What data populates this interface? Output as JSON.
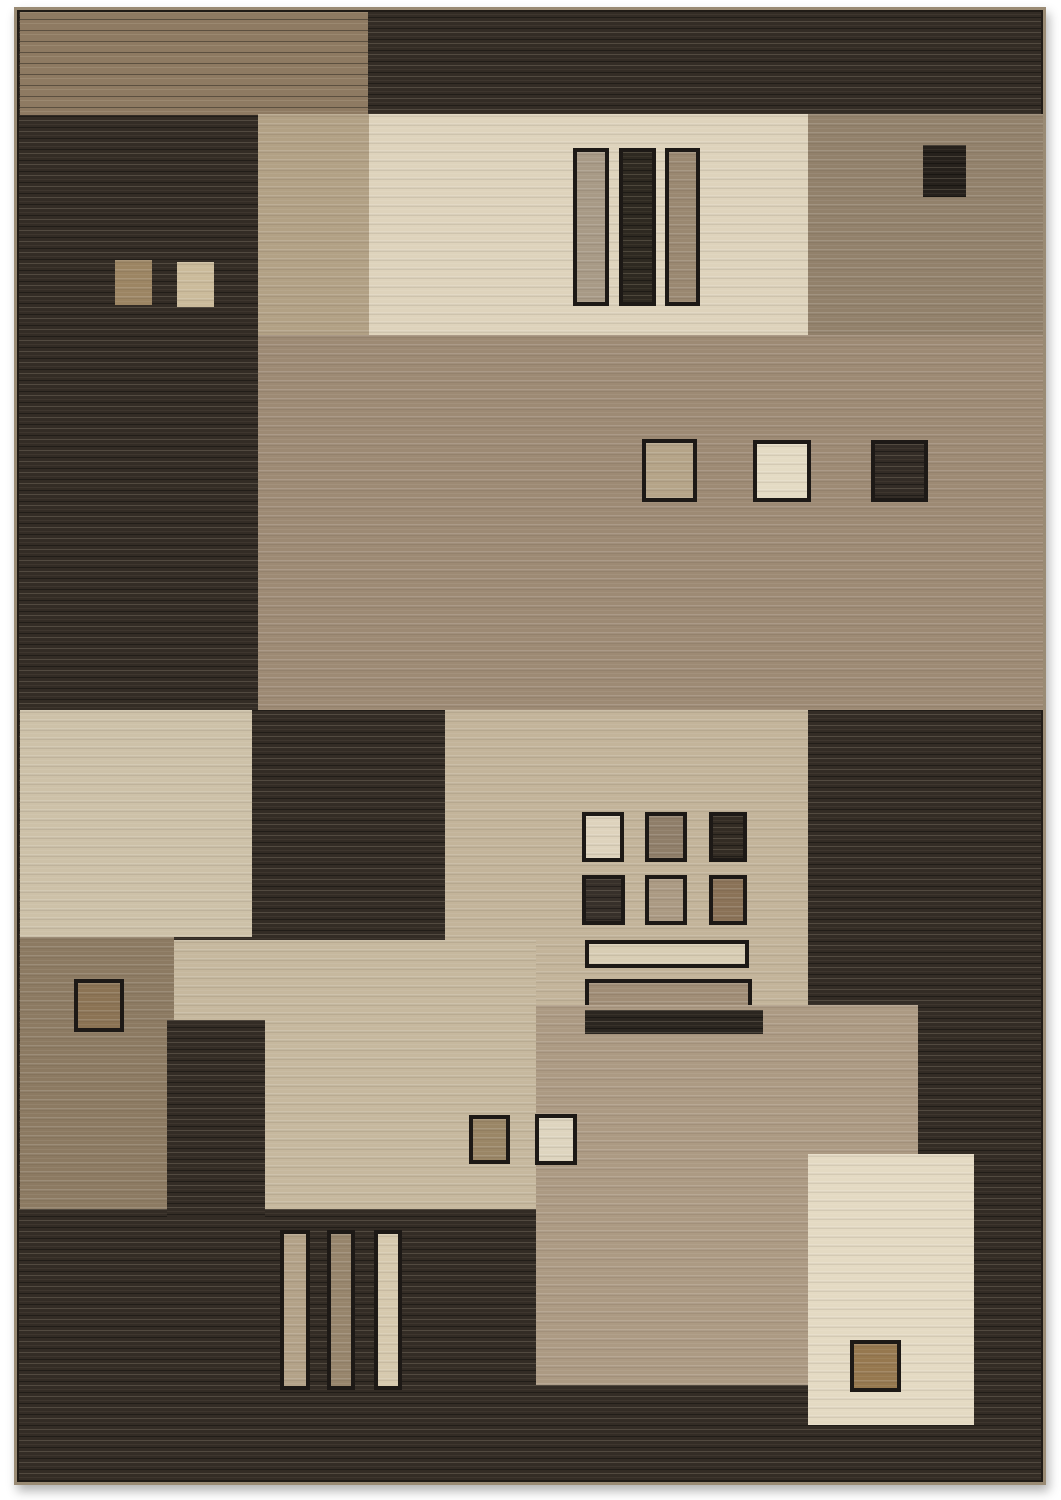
{
  "image": {
    "description": "Product photograph of a modern geometric area rug with striated pile, composed of overlapping rectangles and small squares in dark espresso, brown, taupe, beige and cream tones on a white background.",
    "page_background": "#ffffff",
    "palette": {
      "dark_espresso": "#332c25",
      "brown": "#8e7a62",
      "taupe": "#92816b",
      "tan": "#9d8a74",
      "light_tan": "#b2a185",
      "beige": "#c3b49a",
      "cream": "#ded3bc",
      "outline": "#1d1916",
      "binding_edge": "#9a8b74"
    }
  },
  "rug": {
    "x": 14,
    "y": 7,
    "width": 1032,
    "height": 1478,
    "base_color": "#332c25",
    "panels": [
      {
        "name": "top-brown-band",
        "x": 3,
        "y": 2,
        "w": 348,
        "h": 103,
        "color": "#8e7a62",
        "texture": "dark",
        "border": false
      },
      {
        "name": "upper-tan-column",
        "x": 241,
        "y": 104,
        "w": 111,
        "h": 221,
        "color": "#b2a185",
        "texture": "light",
        "border": false
      },
      {
        "name": "top-cream-panel",
        "x": 352,
        "y": 104,
        "w": 439,
        "h": 221,
        "color": "#ded3bc",
        "texture": "light",
        "border": false
      },
      {
        "name": "cream-panel-bar-left",
        "x": 556,
        "y": 138,
        "w": 36,
        "h": 158,
        "color": "#a89a86",
        "texture": "light",
        "border": true
      },
      {
        "name": "cream-panel-bar-middle",
        "x": 602,
        "y": 138,
        "w": 37,
        "h": 158,
        "color": "#2e2921",
        "texture": "dark",
        "border": true
      },
      {
        "name": "cream-panel-bar-right",
        "x": 648,
        "y": 138,
        "w": 35,
        "h": 158,
        "color": "#9a8871",
        "texture": "light",
        "border": true
      },
      {
        "name": "top-right-taupe-panel",
        "x": 791,
        "y": 104,
        "w": 235,
        "h": 221,
        "color": "#92816b",
        "texture": "light",
        "border": false
      },
      {
        "name": "taupe-panel-dark-square",
        "x": 906,
        "y": 135,
        "w": 43,
        "h": 52,
        "color": "#26211c",
        "texture": "dark",
        "border": false
      },
      {
        "name": "middle-tan-band",
        "x": 241,
        "y": 325,
        "w": 785,
        "h": 375,
        "color": "#9d8a74",
        "texture": "light",
        "border": false
      },
      {
        "name": "tan-band-square-tan",
        "x": 625,
        "y": 429,
        "w": 55,
        "h": 63,
        "color": "#b5a488",
        "texture": "light",
        "border": true
      },
      {
        "name": "tan-band-square-cream",
        "x": 736,
        "y": 430,
        "w": 58,
        "h": 62,
        "color": "#e4dbc4",
        "texture": "light",
        "border": true
      },
      {
        "name": "tan-band-square-dark",
        "x": 854,
        "y": 430,
        "w": 57,
        "h": 62,
        "color": "#332c26",
        "texture": "dark",
        "border": true
      },
      {
        "name": "dark-field-square-brown",
        "x": 98,
        "y": 250,
        "w": 37,
        "h": 45,
        "color": "#9c8563",
        "texture": "light",
        "border": false
      },
      {
        "name": "dark-field-square-cream",
        "x": 160,
        "y": 252,
        "w": 37,
        "h": 45,
        "color": "#cbbb9b",
        "texture": "light",
        "border": false
      },
      {
        "name": "left-cream-panel",
        "x": 3,
        "y": 700,
        "w": 232,
        "h": 227,
        "color": "#cdc1a8",
        "texture": "light",
        "border": false
      },
      {
        "name": "center-beige-square",
        "x": 428,
        "y": 700,
        "w": 363,
        "h": 295,
        "color": "#c3b49a",
        "texture": "light",
        "border": false
      },
      {
        "name": "grid-square-r1-cream",
        "x": 565,
        "y": 802,
        "w": 42,
        "h": 50,
        "color": "#ded3bd",
        "texture": "light",
        "border": true
      },
      {
        "name": "grid-square-r1-taupe",
        "x": 628,
        "y": 802,
        "w": 42,
        "h": 50,
        "color": "#8f7e69",
        "texture": "light",
        "border": true
      },
      {
        "name": "grid-square-r1-dark",
        "x": 692,
        "y": 802,
        "w": 38,
        "h": 50,
        "color": "#332c24",
        "texture": "dark",
        "border": true
      },
      {
        "name": "grid-square-r2-dark",
        "x": 565,
        "y": 865,
        "w": 43,
        "h": 50,
        "color": "#37302a",
        "texture": "dark",
        "border": true
      },
      {
        "name": "grid-square-r2-beige",
        "x": 628,
        "y": 865,
        "w": 42,
        "h": 50,
        "color": "#ab9a83",
        "texture": "light",
        "border": true
      },
      {
        "name": "grid-square-r2-brown",
        "x": 692,
        "y": 865,
        "w": 38,
        "h": 50,
        "color": "#8a7257",
        "texture": "light",
        "border": true
      },
      {
        "name": "beige-square-bar-cream",
        "x": 568,
        "y": 930,
        "w": 164,
        "h": 28,
        "color": "#d8cdb4",
        "texture": "light",
        "border": true
      },
      {
        "name": "beige-square-bar-taupe",
        "x": 568,
        "y": 969,
        "w": 167,
        "h": 30,
        "color": "#a08d76",
        "texture": "light",
        "border": true
      },
      {
        "name": "lower-left-taupe-panel",
        "x": 3,
        "y": 927,
        "w": 154,
        "h": 272,
        "color": "#8c7a62",
        "texture": "light",
        "border": false
      },
      {
        "name": "taupe-panel-brown-square",
        "x": 57,
        "y": 969,
        "w": 50,
        "h": 53,
        "color": "#8b7354",
        "texture": "light",
        "border": true
      },
      {
        "name": "lower-left-beige-panel",
        "x": 157,
        "y": 930,
        "w": 362,
        "h": 269,
        "color": "#c6b89e",
        "texture": "light",
        "border": false
      },
      {
        "name": "lower-dark-column",
        "x": 150,
        "y": 1010,
        "w": 98,
        "h": 197,
        "color": "#332c25",
        "texture": "dark",
        "border": false
      },
      {
        "name": "big-tan-square",
        "x": 519,
        "y": 995,
        "w": 382,
        "h": 380,
        "color": "#ac9a83",
        "texture": "light",
        "border": false
      },
      {
        "name": "beige-square-bar-dark",
        "x": 568,
        "y": 1000,
        "w": 178,
        "h": 24,
        "color": "#2b2620",
        "texture": "dark",
        "border": false
      },
      {
        "name": "pair-square-brown",
        "x": 452,
        "y": 1105,
        "w": 41,
        "h": 49,
        "color": "#9a8666",
        "texture": "light",
        "border": true
      },
      {
        "name": "pair-square-cream",
        "x": 518,
        "y": 1104,
        "w": 42,
        "h": 51,
        "color": "#ded5bf",
        "texture": "light",
        "border": true
      },
      {
        "name": "bottom-right-cream-panel",
        "x": 791,
        "y": 1144,
        "w": 166,
        "h": 271,
        "color": "#e4dac3",
        "texture": "light",
        "border": false
      },
      {
        "name": "cream-panel-brown-square",
        "x": 833,
        "y": 1330,
        "w": 51,
        "h": 52,
        "color": "#96784f",
        "texture": "light",
        "border": true
      },
      {
        "name": "bottom-vbar-tan",
        "x": 263,
        "y": 1220,
        "w": 30,
        "h": 160,
        "color": "#b3a288",
        "texture": "light",
        "border": true
      },
      {
        "name": "bottom-vbar-taupe",
        "x": 310,
        "y": 1220,
        "w": 28,
        "h": 160,
        "color": "#97856c",
        "texture": "light",
        "border": true
      },
      {
        "name": "bottom-vbar-cream",
        "x": 357,
        "y": 1220,
        "w": 28,
        "h": 160,
        "color": "#d6c9ae",
        "texture": "light",
        "border": true
      }
    ]
  }
}
